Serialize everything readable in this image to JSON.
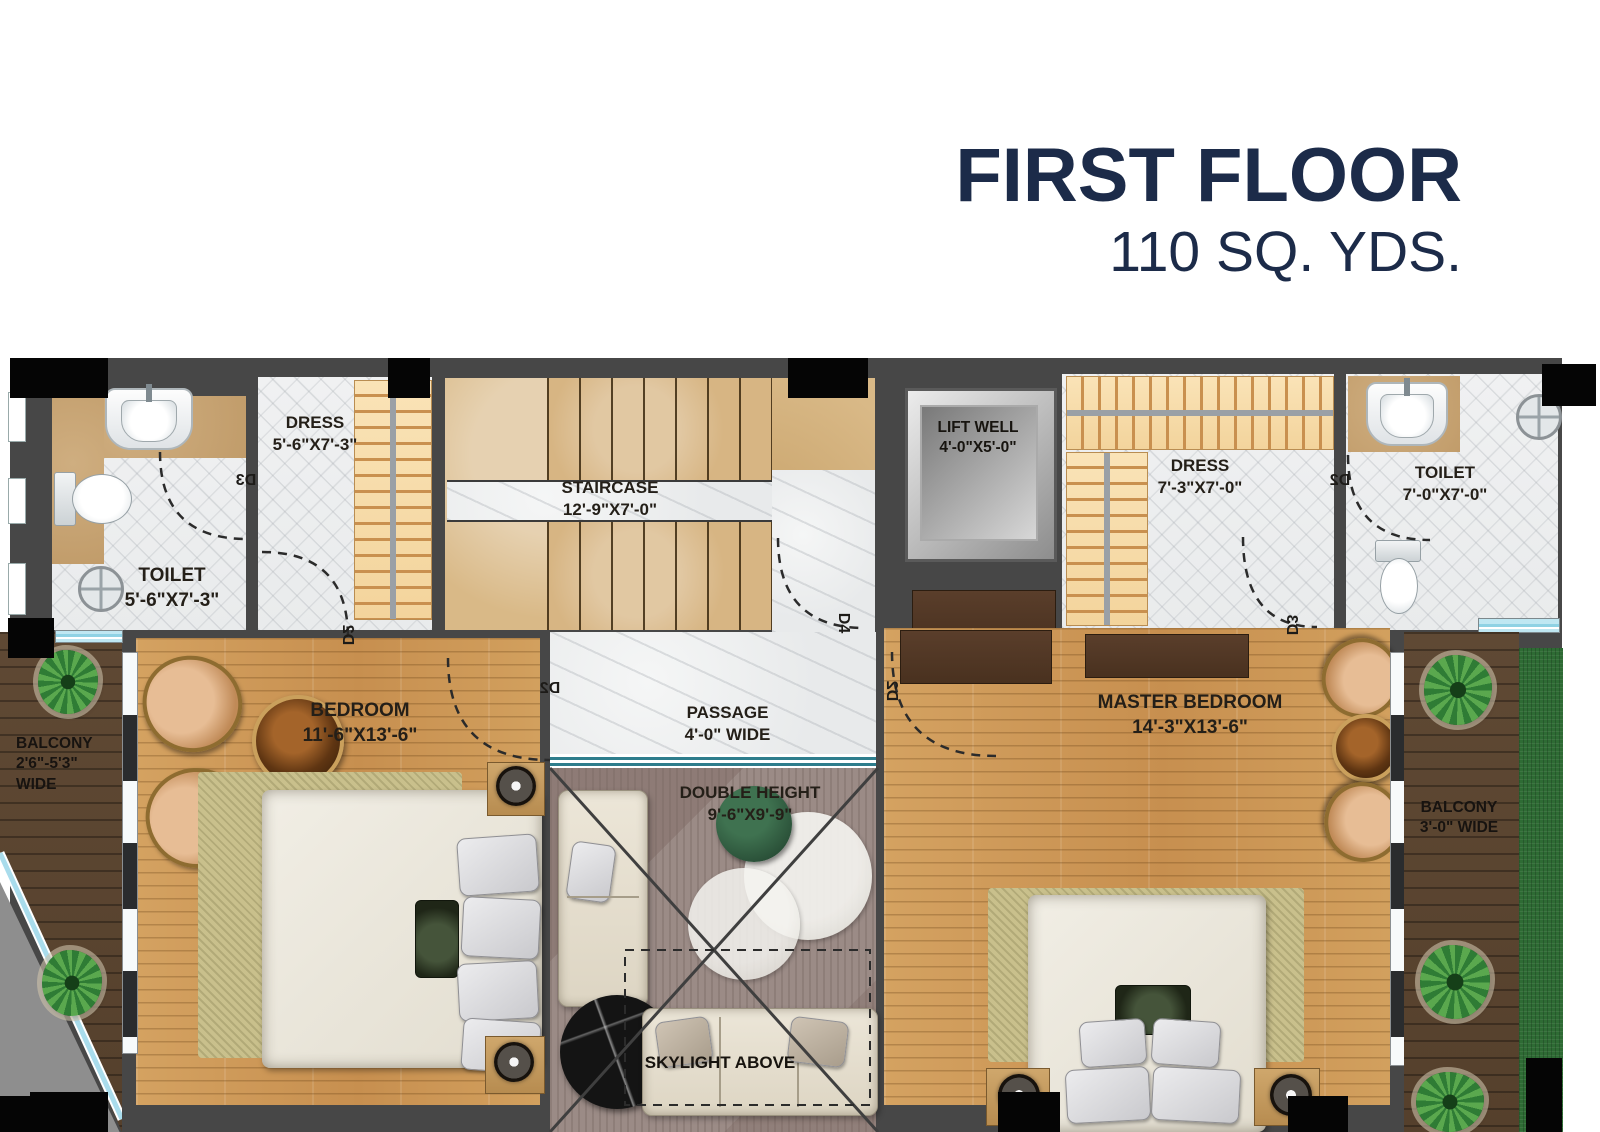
{
  "header": {
    "title": "FIRST FLOOR",
    "subtitle": "110 SQ. YDS."
  },
  "rooms": {
    "toilet_left": {
      "name": "TOILET",
      "dims": "5'-6\"X7'-3\""
    },
    "dress_left": {
      "name": "DRESS",
      "dims": "5'-6\"X7'-3\""
    },
    "staircase": {
      "name": "STAIRCASE",
      "dims": "12'-9\"X7'-0\""
    },
    "lift_well": {
      "name": "LIFT WELL",
      "dims": "4'-0\"X5'-0\""
    },
    "dress_right": {
      "name": "DRESS",
      "dims": "7'-3\"X7'-0\""
    },
    "toilet_right": {
      "name": "TOILET",
      "dims": "7'-0\"X7'-0\""
    },
    "bedroom": {
      "name": "BEDROOM",
      "dims": "11'-6\"X13'-6\""
    },
    "passage": {
      "name": "PASSAGE",
      "dims": "4'-0\" WIDE"
    },
    "double_height": {
      "name": "DOUBLE HEIGHT",
      "dims": "9'-6\"X9'-9\""
    },
    "master_bedroom": {
      "name": "MASTER BEDROOM",
      "dims": "14'-3\"X13'-6\""
    },
    "balcony_left": {
      "name": "BALCONY",
      "dims": "2'6\"-5'3\" WIDE"
    },
    "balcony_right": {
      "name": "BALCONY",
      "dims": "3'-0\" WIDE"
    },
    "skylight": {
      "label": "SKYLIGHT ABOVE"
    }
  },
  "doors": {
    "toilet_left_door": "D3",
    "dress_left_door": "D2",
    "stair_door": "D4",
    "passage_left_door": "D2",
    "master_door": "D2",
    "dress_right_door": "D3",
    "toilet_right_door": "D2"
  },
  "colors": {
    "accent_navy": "#1c2b49",
    "wall": "#474747",
    "wood": "#cf9b58",
    "deck": "#5e4833",
    "grass": "#2e6b34",
    "stair": "#d9b987",
    "marble": "#eff1f2",
    "wardrobe": "#f8dfae"
  }
}
